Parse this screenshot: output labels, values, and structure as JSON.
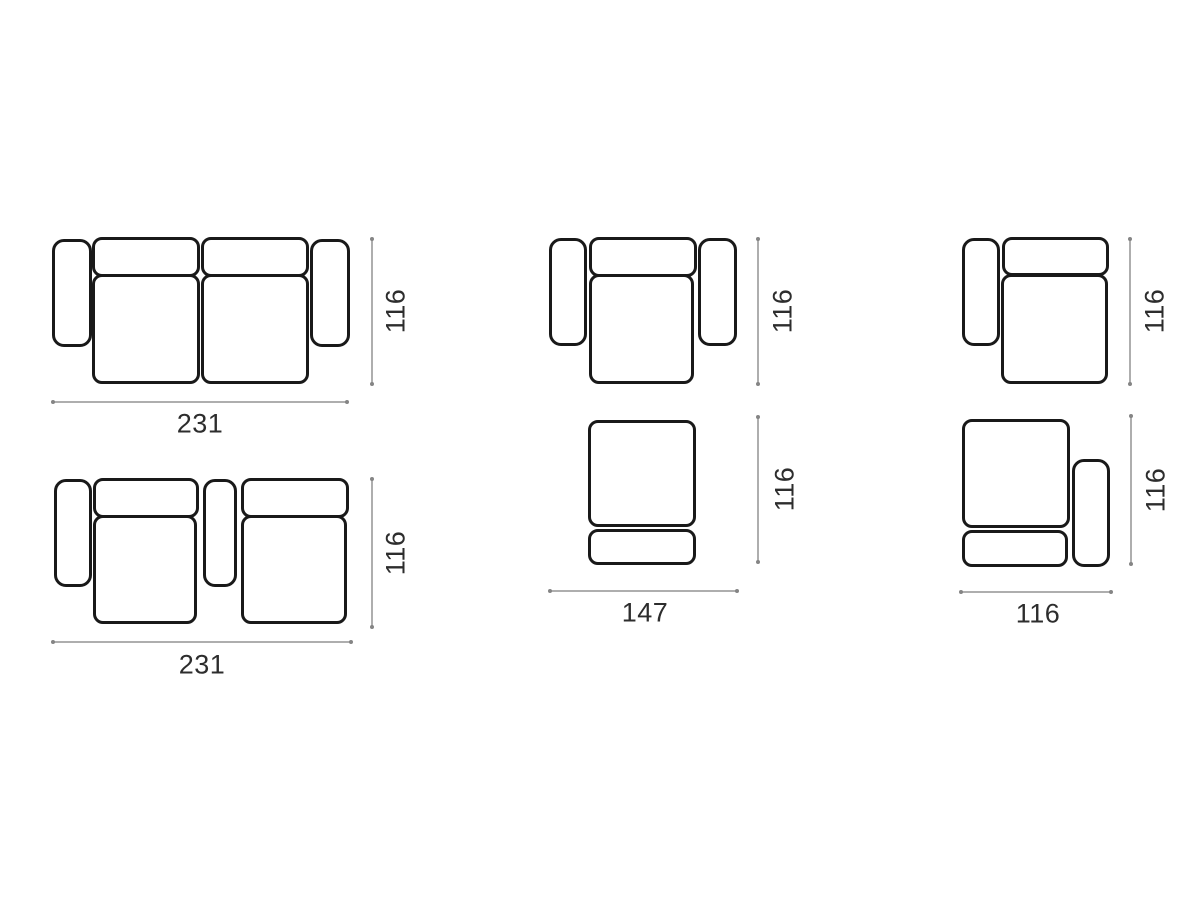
{
  "diagram": {
    "colors": {
      "background": "#ffffff",
      "outline": "#191919",
      "dimension_line": "#aeaeae",
      "label_text": "#2d2d2d"
    },
    "figures": {
      "sofa_two_arms": {
        "width": "231",
        "height": "116"
      },
      "sofa_console": {
        "width": "231",
        "height": "116"
      },
      "armchair": {
        "height": "116"
      },
      "armless_module": {
        "width": "147",
        "height": "116"
      },
      "left_arm_module": {
        "height": "116"
      },
      "right_arm_module": {
        "width": "116",
        "height": "116"
      }
    }
  }
}
